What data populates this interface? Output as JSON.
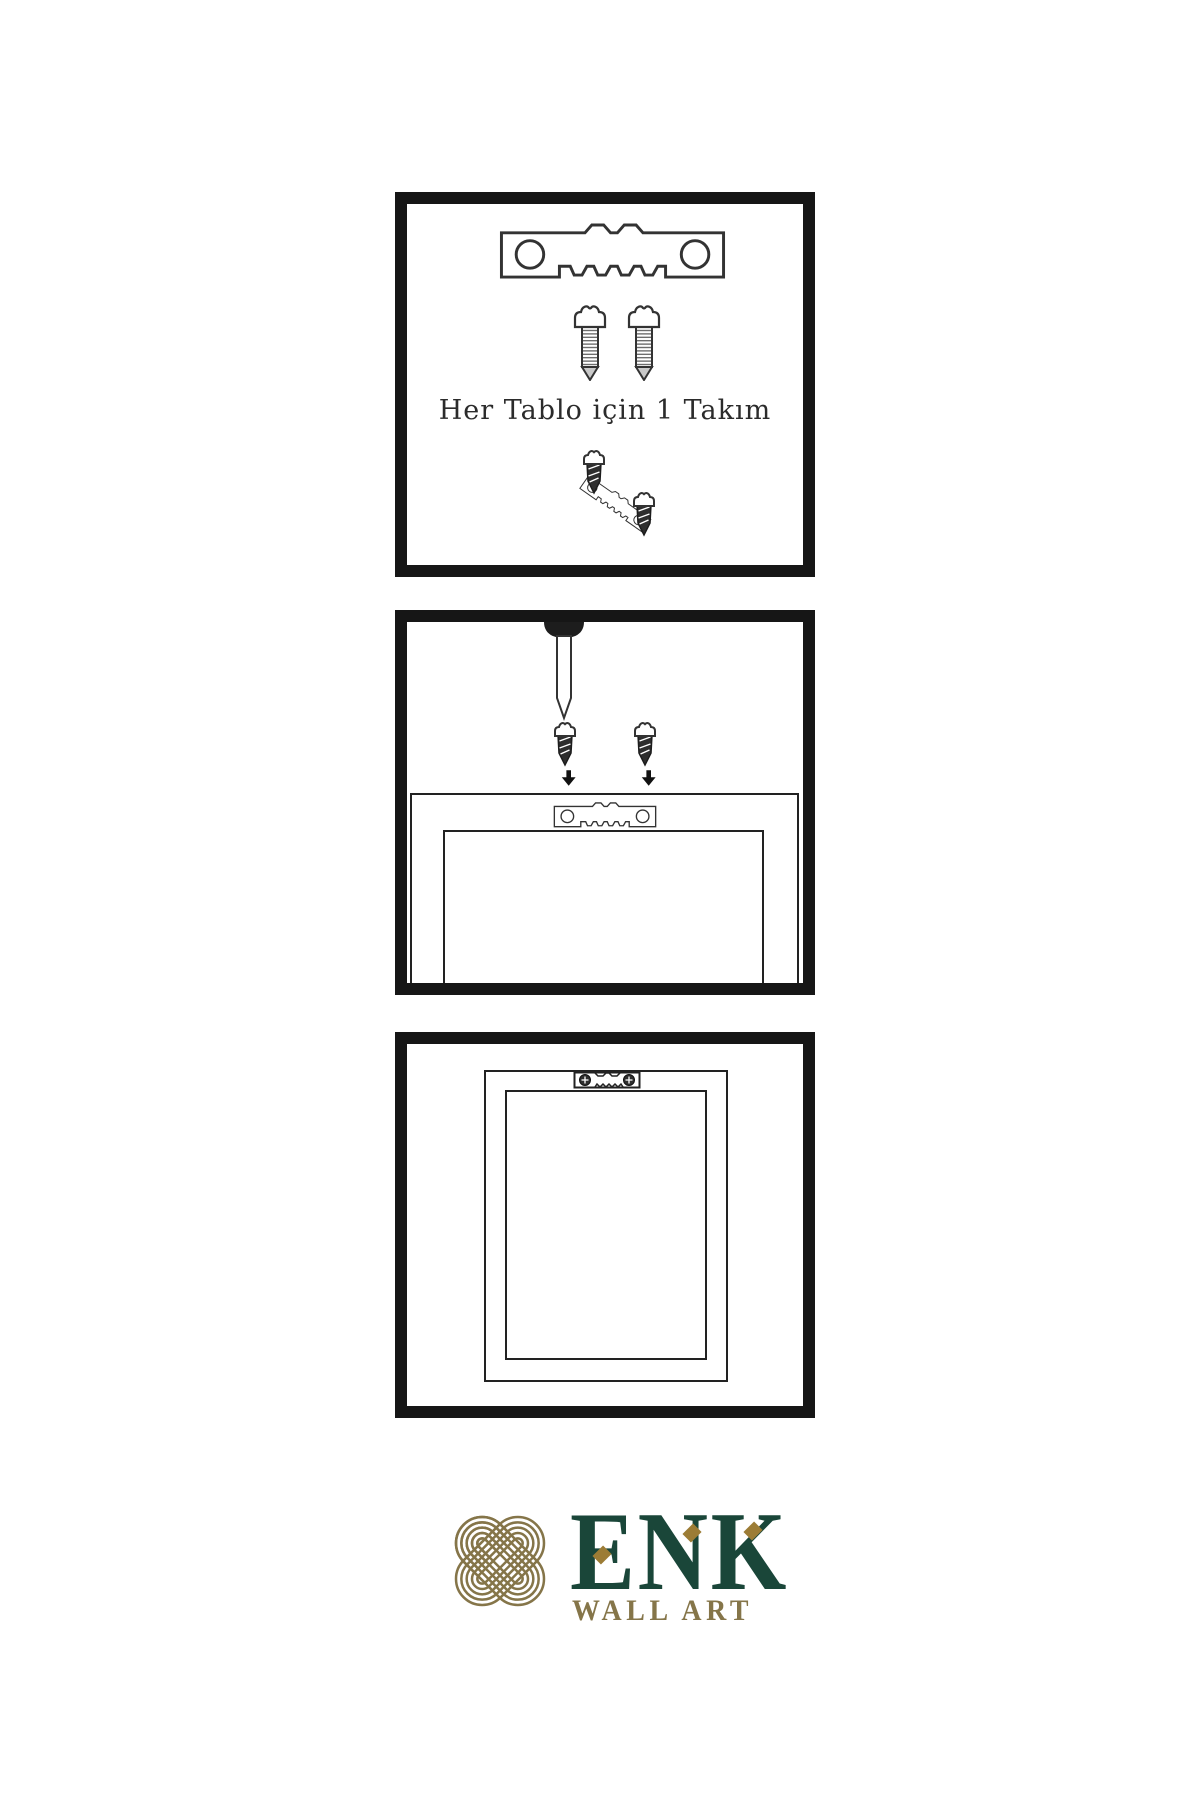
{
  "page": {
    "background": "#ffffff",
    "type": "wall-art-hanging-instructions"
  },
  "colors": {
    "ink": "#333333",
    "panel-border": "#161616",
    "dark-fill": "#2e2e2e",
    "caption-color": "#2b2b2b",
    "logo-green": "#1a4639",
    "logo-gold": "#857549",
    "logo-gold-bright": "#9c7c35",
    "page-bg": "#ffffff"
  },
  "panels": {
    "step1": {
      "caption": "Her Tablo için 1 Takım",
      "icons": [
        "sawtooth-hanger",
        "screw",
        "screw",
        "screw-driving-into-tilted-hanger"
      ]
    },
    "step2": {
      "icons": [
        "wall-nail",
        "screw-with-down-arrow",
        "screw-with-down-arrow",
        "frame-back-top",
        "mounted-sawtooth-hanger"
      ]
    },
    "step3": {
      "icons": [
        "hanging-frame",
        "mounted-sawtooth-hanger-with-screws"
      ]
    }
  },
  "logo": {
    "brand": "ENK",
    "subtitle": "WALL ART",
    "symbol": "interlocked-knot"
  }
}
